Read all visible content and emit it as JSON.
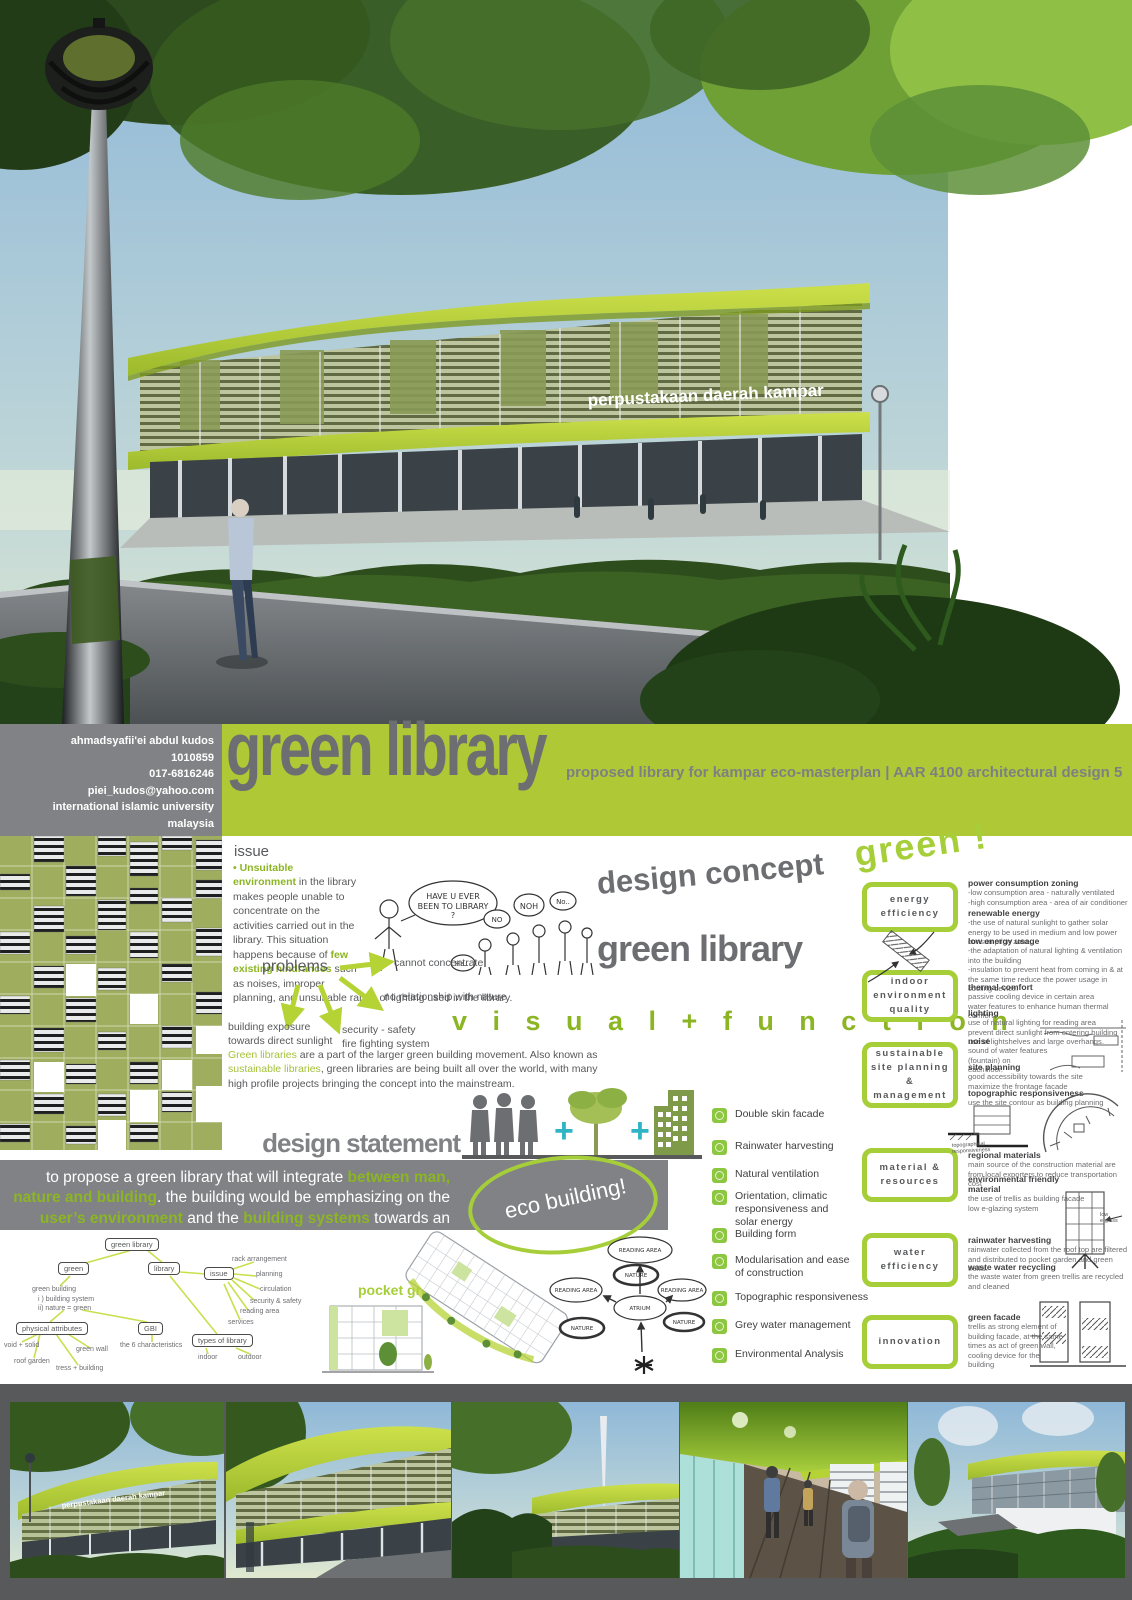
{
  "header": {
    "author_lines": [
      "ahmadsyafii'ei abdul kudos",
      "1010859",
      "017-6816246",
      "piei_kudos@yahoo.com",
      "international islamic university malaysia"
    ],
    "title": "green library",
    "subtitle": "proposed library for kampar eco-masterplan | AAR 4100 architectural design 5"
  },
  "hero": {
    "building_sign": "perpustakaan daerah kampar"
  },
  "issue": {
    "heading": "issue",
    "seg1": "•  Unsuitable environment",
    "seg2": " in the library makes people unable to concentrate on the activities carried out in the library. This situation happens because of ",
    "seg3": "few existing hindrances",
    "seg4": " such as noises, improper planning, and unsuitable range of lighting used in the library."
  },
  "sketch": {
    "bubble_l1": "HAVE U EVER",
    "bubble_l2": "BEEN TO LIBRARY",
    "bubble_l3": "?",
    "no1": "NO",
    "no2": "NOH",
    "no3": "No..",
    "no4": "Ha..."
  },
  "problems": {
    "label": "problems",
    "items": [
      "cannot concentrate",
      "no relationship with nature",
      "building exposure\ntowards direct sunlight",
      "security - safety\nfire fighting system"
    ]
  },
  "concept": {
    "line1": "design concept",
    "line2": "green library",
    "line3": "v i s u a l   +   f u n c t i o n"
  },
  "green_paragraph": {
    "seg1": "Green libraries",
    "seg2": " are a part of the larger green building movement. Also known as ",
    "seg3": "sustainable libraries",
    "seg4": ", green libraries are being built all over the world, with many high profile projects bringing the concept into the mainstream."
  },
  "statement": {
    "heading": "design statement",
    "seg1": "to propose a green library that will integrate ",
    "seg2": "between man, nature and building",
    "seg3": ". the building would be emphasizing on the ",
    "seg4": "user’s environment",
    "seg5": " and the ",
    "seg6": "building systems",
    "seg7": " towards an ‘eco design’.",
    "plus1": "+",
    "plus2": "+"
  },
  "eco_bubble": "eco building!",
  "mindmap": {
    "root": "green library",
    "green": "green",
    "library": "library",
    "issue": "issue",
    "green_building": "green building",
    "note": "i ) building system\nii) nature = green",
    "physical": "physical attributes",
    "gbi": "GBI",
    "six": "the 6 characteristics",
    "void": "void + solid",
    "roof": "roof garden",
    "wall": "green wall",
    "tress": "tress + building",
    "rack": "rack arrangement",
    "planning": "planning",
    "circulation": "circulation",
    "security": "security & safety",
    "reading": "reading area",
    "services": "services",
    "types": "types of library",
    "indoor": "indoor",
    "outdoor": "outdoor"
  },
  "pocket_green": {
    "label": "pocket green"
  },
  "bubbles": {
    "reading_top": "READING AREA",
    "nature_top": "NATURE",
    "reading_left": "READING AREA",
    "reading_right": "READING AREA",
    "atrium": "ATRIUM",
    "nature_left": "NATURE",
    "nature_right": "NATURE"
  },
  "checklist": [
    "Double skin facade",
    "Rainwater harvesting",
    "Natural ventilation",
    "Orientation, climatic\nresponsiveness and\nsolar energy",
    "Building form",
    "Modularisation and ease\nof construction",
    "Topographic responsiveness",
    "Grey water management",
    "Environmental Analysis"
  ],
  "green_bang": "green !",
  "categories": [
    {
      "label": "energy efficiency"
    },
    {
      "label": "indoor environment\nquality"
    },
    {
      "label": "sustainable\nsite planning &\nmanagement"
    },
    {
      "label": "material &\nresources"
    },
    {
      "label": "water efficiency"
    },
    {
      "label": "innovation"
    }
  ],
  "detail_sections": [
    {
      "title": "power consumption zoning",
      "body": "-low consumption area - naturally ventilated\n-high consumption area - area of air conditioner"
    },
    {
      "title": "renewable energy",
      "body": "-the use of natural sunlight to gather solar energy to be used in medium and low power consumption zone."
    },
    {
      "title": "low energy usage",
      "body": "-the adaptation of natural lighting & ventilation into the building\n-insulation to prevent heat from coming in & at the same time reduce the power usage in cooling device."
    },
    {
      "title": "thermal comfort",
      "body": "passive cooling device in certain area\nwater features to enhance human thermal comfort"
    },
    {
      "title": "lighting",
      "body": "use of natural lighting for reading area\nprevent direct sunlight from entering building\nuse of lightshelves and large overhangs."
    },
    {
      "title": "noise",
      "body": "sound of water features (fountain) on\neach floor."
    },
    {
      "title": "site planning",
      "body": "good accessibility towards the site\nmaximize the frontage facade"
    },
    {
      "title": "topographic responsiveness",
      "body": "use the site contour as building planning"
    },
    {
      "title": "regional materials",
      "body": "main source of the construction material are from local exporters to reduce transportation cost"
    },
    {
      "title": "environmental friendly material",
      "body": "the use of trellis as building facade\nlow e-glazing system"
    },
    {
      "title": "rainwater harvesting",
      "body": "rainwater collected from the roof top are filtered and distributed to pocket garden and green trellis."
    },
    {
      "title": "waste water recycling",
      "body": "the waste water from green trellis are recycled and cleaned"
    },
    {
      "title": "green facade",
      "body": "trellis as strong element of\nbuilding facade, at the same\ntimes as act of green wall,\ncooling device for the\nbuilding"
    }
  ],
  "sketch_notes": {
    "topo": "topographical\nresponsiveness",
    "low_e": "low\ne-glass"
  },
  "bottom": {
    "sign": "perpustakaan daerah kampar"
  },
  "colors": {
    "lime": "#aec836",
    "accent_green": "#8cb524",
    "gray_band": "#808285",
    "dark_strip": "#58595b",
    "title_gray": "#6d6e71",
    "teal": "#2fb4c4"
  }
}
